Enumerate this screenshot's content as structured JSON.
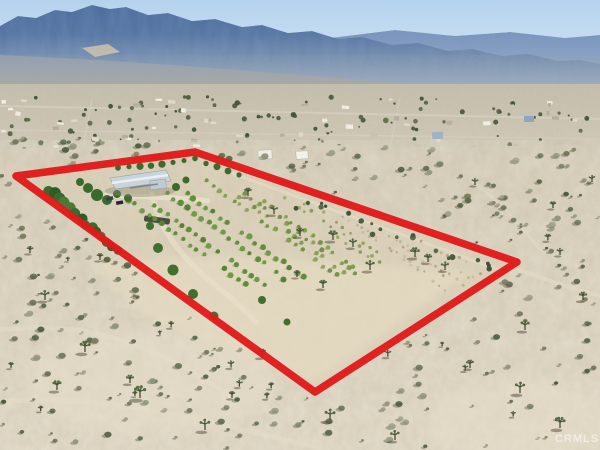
{
  "photo": {
    "kind": "aerial-drone-real-estate-photo",
    "scene": "Desert valley property with a light-roofed home, windbreak tree row and orchard rows, outlined in red; scrub desert in foreground, small town mid-ground and hazy blue mountain range under a pale sky",
    "watermark": "CRMLS"
  },
  "boundary": {
    "points": "16,176 195,152 517,262 315,392",
    "color": "#e01a1a",
    "width": "7.5"
  },
  "palette": {
    "sky_top": "#b9d5ee",
    "sky_bottom": "#dceaf6",
    "mountain": "#50709f",
    "mountain_shadow": "#2e4c7c",
    "far_ridge": "#7e97c0",
    "foothill": "#9aa5b0",
    "valley_floor": "#cfc7b3",
    "desert": "#d7ceb9",
    "sand_light": "#e7decb",
    "scrub": "#6e7558",
    "orchard_green": "#6f9c49",
    "tree_dark_green": "#3c6a2e",
    "house_roof": "#c9d3da",
    "boundary_red": "#e01a1a"
  }
}
